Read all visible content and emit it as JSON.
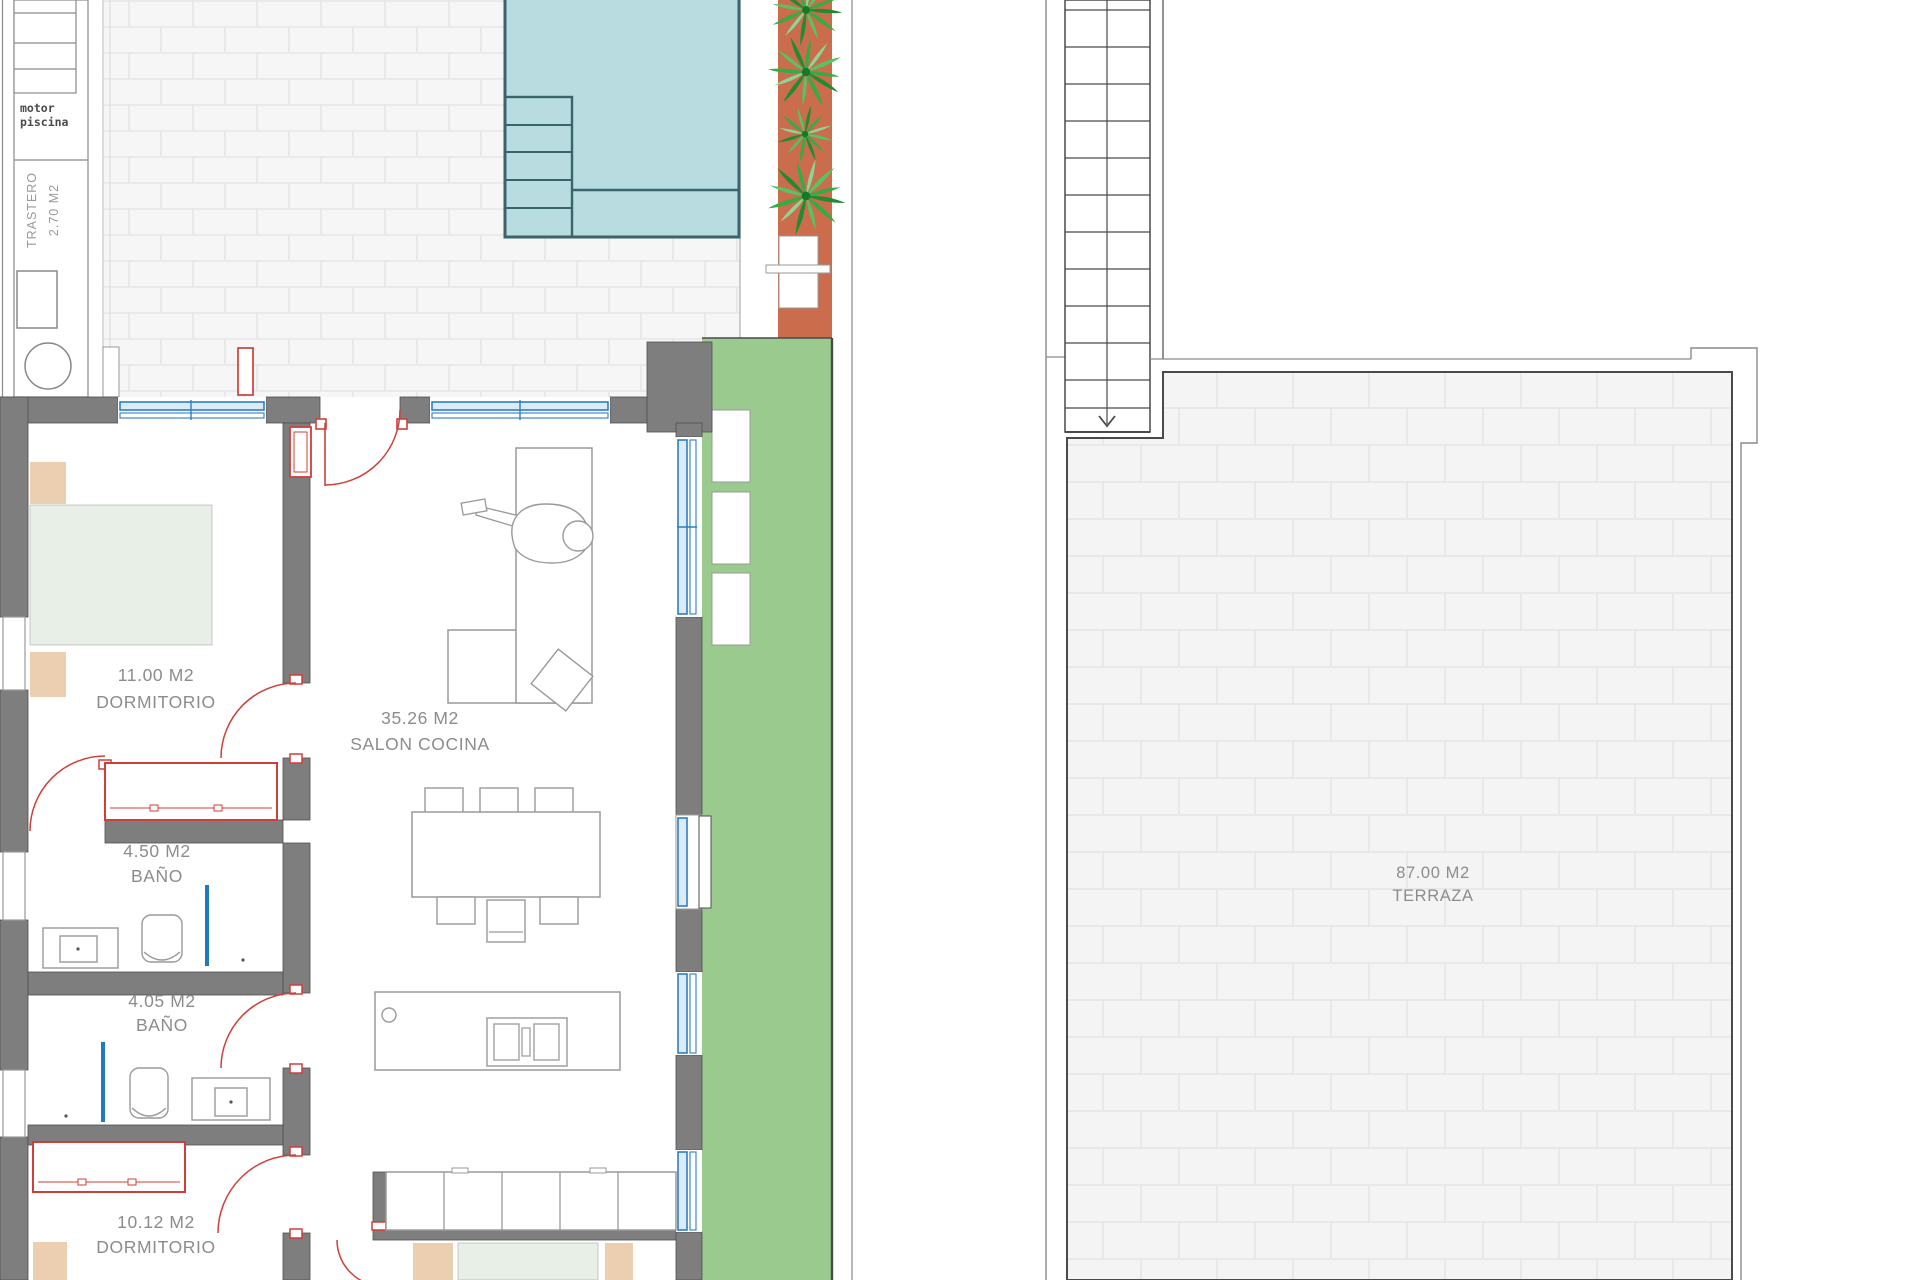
{
  "plan": {
    "storage": {
      "motor_line1": "motor",
      "motor_line2": "piscina",
      "trastero_line1": "TRASTERO",
      "trastero_line2": "2.70 M2"
    },
    "rooms": {
      "dormitorio1": {
        "area": "11.00 M2",
        "name": "DORMITORIO"
      },
      "salon": {
        "area": "35.26 M2",
        "name": "SALON COCINA"
      },
      "bano1": {
        "area": "4.50 M2",
        "name": "BAÑO"
      },
      "bano2": {
        "area": "4.05 M2",
        "name": "BAÑO"
      },
      "dormitorio2": {
        "area": "10.12 M2",
        "name": "DORMITORIO"
      },
      "terraza": {
        "area": "87.00 M2",
        "name": "TERRAZA"
      }
    }
  },
  "theme": {
    "fills": {
      "wall": "#7e7e7e",
      "pool": "#b9dce0",
      "planter": "#cb6c4c",
      "grass": "#9bca8e",
      "bed": "#e7efe6",
      "wood": "#eccfb0",
      "glass": "#d9ecf7",
      "white": "#ffffff",
      "label": "#8c8c8c",
      "label_dark": "#4a4a4a",
      "label_light": "#9a9a9a",
      "palm_dark": "#1f8c31",
      "palm_mid": "#2fae43",
      "palm_light": "#54c465",
      "palm_pale": "#8ad694"
    },
    "strokes": {
      "pool_edge": "#3a646c",
      "window": "#2f7fc1",
      "door": "#cf3f3a",
      "outline": "#9a9a9a",
      "wall_edge": "#4f4f4f",
      "stair": "#4a4a4a",
      "boundary": "#8a8a8a",
      "shower": "#1f7ac2"
    }
  }
}
